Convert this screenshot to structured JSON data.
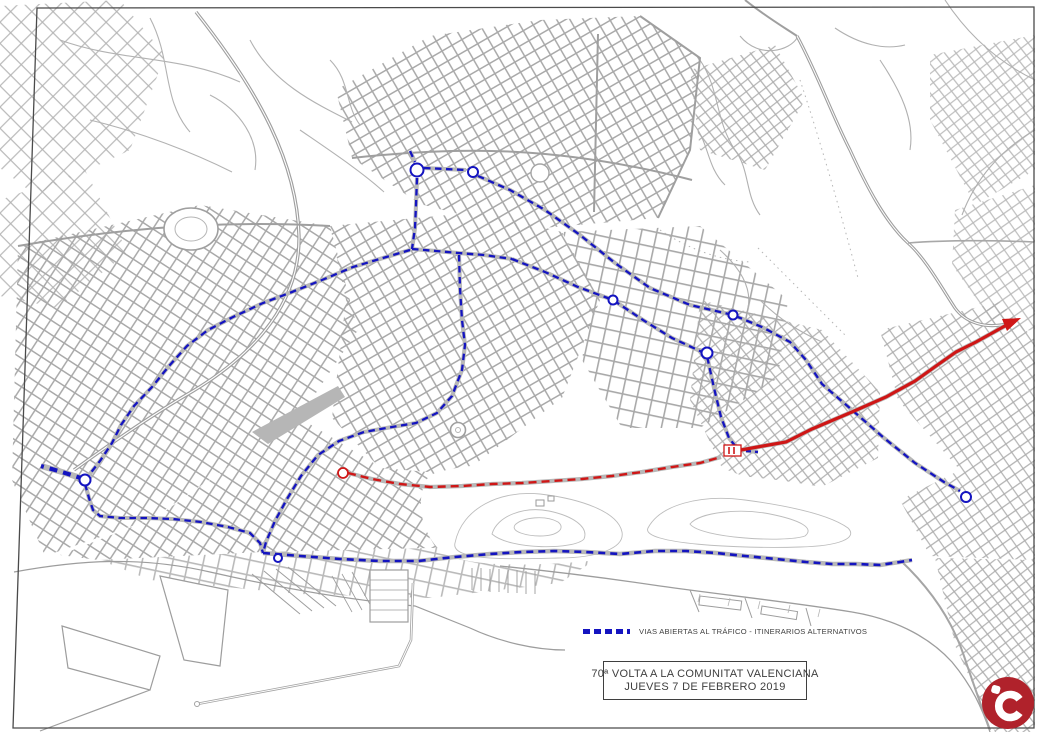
{
  "legend": {
    "label": "VIAS ABIERTAS AL TRÁFICO - ITINERARIOS ALTERNATIVOS"
  },
  "title_box": {
    "line1": "70ª VOLTA A LA COMUNITAT VALENCIANA",
    "line2": "JUEVES 7 DE FEBRERO 2019"
  },
  "logo": {
    "monogram": "iC"
  },
  "colors": {
    "open_roads_blue": "#1414c0",
    "race_route_red": "#cf1616",
    "street_gray": "#a9a9a9",
    "route_underlay_gray": "#b8b8b8",
    "logo_red": "#b0222b",
    "frame_gray": "#4a4a4a",
    "text_gray": "#3e3e3e"
  },
  "routes": {
    "open_roads": [
      {
        "id": "north-stub",
        "width": 2.3,
        "dash": "6.5 4.5",
        "points": [
          [
            410,
            151
          ],
          [
            415,
            162
          ]
        ]
      },
      {
        "id": "ring-connector",
        "width": 2.3,
        "dash": "6.5 4.5",
        "points": [
          [
            424,
            168
          ],
          [
            466,
            170
          ]
        ]
      },
      {
        "id": "diagonal-upper",
        "width": 2.3,
        "dash": "6.5 4.5",
        "points": [
          [
            478,
            176
          ],
          [
            510,
            190
          ],
          [
            545,
            210
          ],
          [
            580,
            235
          ],
          [
            615,
            263
          ],
          [
            650,
            288
          ],
          [
            690,
            305
          ],
          [
            733,
            315
          ],
          [
            762,
            327
          ],
          [
            790,
            342
          ],
          [
            806,
            360
          ],
          [
            822,
            384
          ],
          [
            852,
            410
          ],
          [
            884,
            438
          ],
          [
            915,
            463
          ],
          [
            944,
            482
          ],
          [
            960,
            491
          ]
        ]
      },
      {
        "id": "diagonal-lower",
        "width": 2.3,
        "dash": "6.5 4.5",
        "points": [
          [
            512,
            259
          ],
          [
            545,
            272
          ],
          [
            578,
            287
          ],
          [
            613,
            300
          ],
          [
            643,
            320
          ],
          [
            672,
            338
          ],
          [
            700,
            351
          ],
          [
            707,
            356
          ],
          [
            714,
            388
          ],
          [
            721,
            417
          ],
          [
            729,
            438
          ],
          [
            736,
            447
          ]
        ]
      },
      {
        "id": "north-vertical",
        "width": 2.3,
        "dash": "6.5 4.5",
        "points": [
          [
            417,
            178
          ],
          [
            416,
            205
          ],
          [
            415,
            228
          ],
          [
            412,
            249
          ]
        ]
      },
      {
        "id": "mid-horizontal",
        "width": 2.3,
        "dash": "6.5 4.5",
        "points": [
          [
            412,
            249
          ],
          [
            436,
            251
          ],
          [
            458,
            253
          ],
          [
            484,
            255
          ],
          [
            512,
            259
          ]
        ]
      },
      {
        "id": "central-s-curve",
        "width": 2.3,
        "dash": "6.5 4.5",
        "points": [
          [
            459,
            255
          ],
          [
            460,
            288
          ],
          [
            462,
            320
          ],
          [
            465,
            345
          ],
          [
            462,
            370
          ],
          [
            452,
            396
          ],
          [
            437,
            413
          ],
          [
            416,
            423
          ],
          [
            392,
            427
          ],
          [
            364,
            432
          ],
          [
            339,
            441
          ],
          [
            318,
            455
          ],
          [
            301,
            476
          ],
          [
            287,
            499
          ],
          [
            275,
            521
          ],
          [
            266,
            542
          ],
          [
            263,
            553
          ]
        ]
      },
      {
        "id": "southwest-avenue",
        "width": 2.3,
        "dash": "6.5 4.5",
        "points": [
          [
            410,
            250
          ],
          [
            383,
            258
          ],
          [
            353,
            267
          ],
          [
            322,
            280
          ],
          [
            292,
            292
          ],
          [
            263,
            303
          ],
          [
            233,
            317
          ],
          [
            208,
            330
          ],
          [
            187,
            346
          ],
          [
            169,
            366
          ],
          [
            152,
            387
          ],
          [
            134,
            406
          ],
          [
            121,
            425
          ],
          [
            112,
            443
          ],
          [
            100,
            461
          ],
          [
            89,
            475
          ]
        ]
      },
      {
        "id": "west-terminus",
        "width": 4.2,
        "dash": "8 6",
        "points": [
          [
            84,
            479
          ],
          [
            62,
            472
          ],
          [
            41,
            466
          ]
        ]
      },
      {
        "id": "south-loop",
        "width": 2.3,
        "dash": "6.5 4.5",
        "points": [
          [
            85,
            484
          ],
          [
            89,
            498
          ],
          [
            93,
            510
          ],
          [
            100,
            516
          ],
          [
            120,
            518
          ],
          [
            146,
            518
          ],
          [
            173,
            519
          ],
          [
            201,
            522
          ],
          [
            228,
            527
          ],
          [
            250,
            533
          ],
          [
            260,
            543
          ],
          [
            263,
            553
          ]
        ]
      },
      {
        "id": "coastal-avenue",
        "width": 2.6,
        "dash": "7 5",
        "points": [
          [
            263,
            553
          ],
          [
            300,
            556
          ],
          [
            340,
            559
          ],
          [
            380,
            561
          ],
          [
            418,
            561
          ],
          [
            455,
            557
          ],
          [
            490,
            554
          ],
          [
            522,
            552
          ],
          [
            554,
            551
          ],
          [
            586,
            552
          ],
          [
            620,
            554
          ],
          [
            655,
            551
          ],
          [
            686,
            551
          ],
          [
            716,
            553
          ],
          [
            745,
            556
          ],
          [
            776,
            559
          ],
          [
            806,
            562
          ],
          [
            832,
            564
          ],
          [
            856,
            564
          ],
          [
            880,
            565
          ],
          [
            900,
            562
          ],
          [
            912,
            560
          ]
        ]
      },
      {
        "id": "finish-stub",
        "width": 2.3,
        "dash": "5 4",
        "points": [
          [
            746,
            451
          ],
          [
            758,
            452
          ]
        ]
      }
    ],
    "race": {
      "dashed_west": {
        "width": 2.4,
        "dash": "8 5",
        "points": [
          [
            348,
            473
          ],
          [
            372,
            479
          ],
          [
            400,
            484
          ],
          [
            430,
            487
          ],
          [
            462,
            486
          ],
          [
            492,
            484
          ],
          [
            522,
            483
          ],
          [
            552,
            481
          ],
          [
            582,
            479
          ],
          [
            612,
            476
          ],
          [
            642,
            472
          ],
          [
            672,
            467
          ],
          [
            700,
            463
          ],
          [
            721,
            457
          ]
        ]
      },
      "solid_east": {
        "width": 3.2,
        "points": [
          [
            741,
            450
          ],
          [
            763,
            446
          ],
          [
            786,
            442
          ],
          [
            812,
            429
          ],
          [
            852,
            412
          ],
          [
            886,
            397
          ],
          [
            915,
            381
          ],
          [
            936,
            366
          ],
          [
            956,
            352
          ],
          [
            976,
            342
          ],
          [
            1012,
            322
          ]
        ]
      }
    },
    "roundabouts_blue": [
      [
        417,
        170,
        6.5
      ],
      [
        473,
        172,
        5
      ],
      [
        613,
        300,
        4.5
      ],
      [
        733,
        315,
        4.5
      ],
      [
        707,
        353,
        5.5
      ],
      [
        966,
        497,
        5
      ],
      [
        85,
        480,
        5.5
      ],
      [
        278,
        558,
        4
      ]
    ],
    "roundabouts_red": [
      [
        343,
        473,
        5
      ]
    ],
    "finish_box": {
      "x": 724,
      "y": 445,
      "w": 17,
      "h": 11
    },
    "arrow_points": "1021,318 1007,331 1002,319"
  }
}
